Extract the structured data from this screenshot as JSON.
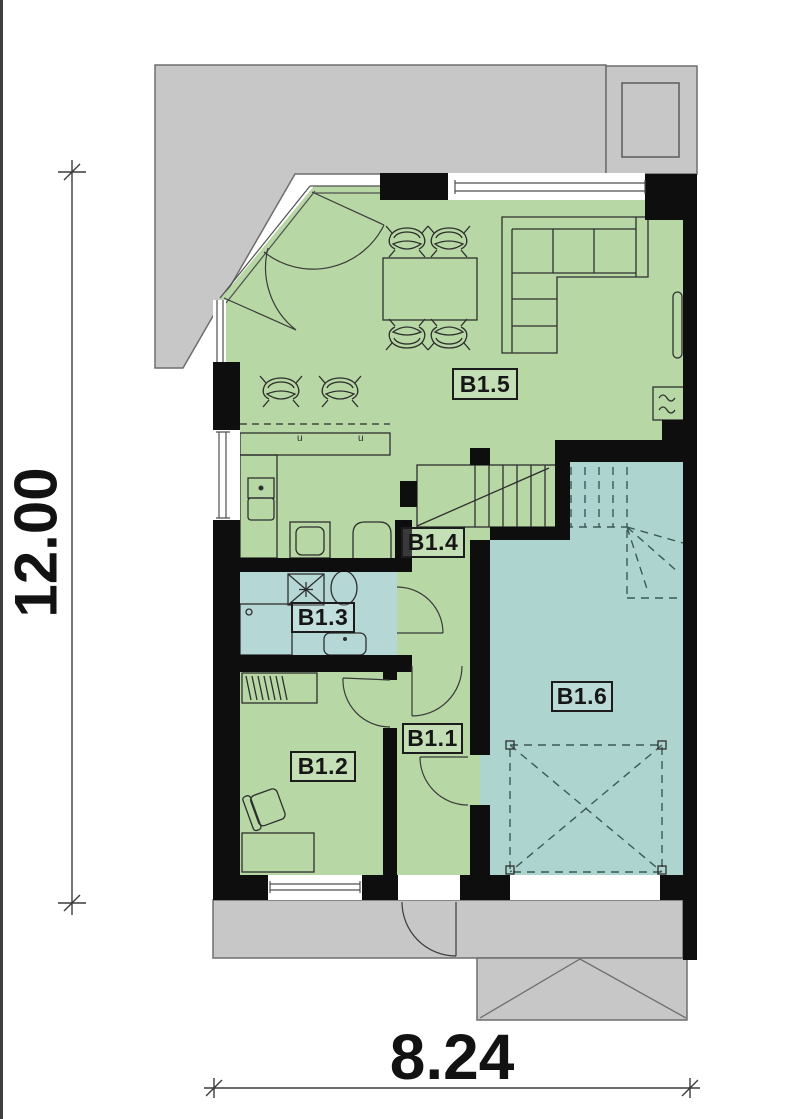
{
  "page": {
    "type": "architectural-floor-plan",
    "floor": "ground floor unit B1"
  },
  "rooms": [
    {
      "id": "b1-5",
      "label": "B1.5",
      "kind": "living-dining-kitchen",
      "color_key": "room-green"
    },
    {
      "id": "b1-4",
      "label": "B1.4",
      "kind": "hallway",
      "color_key": "room-green"
    },
    {
      "id": "b1-3",
      "label": "B1.3",
      "kind": "bathroom",
      "color_key": "room-blue"
    },
    {
      "id": "b1-2",
      "label": "B1.2",
      "kind": "room",
      "color_key": "room-green"
    },
    {
      "id": "b1-1",
      "label": "B1.1",
      "kind": "entrance-hall",
      "color_key": "room-green"
    },
    {
      "id": "b1-6",
      "label": "B1.6",
      "kind": "garage",
      "color_key": "room-blue"
    }
  ],
  "dimensions": {
    "vertical": "12.00",
    "horizontal": "8.24"
  },
  "colors": {
    "room-green": "#b7d7a5",
    "room-blue": "#aed4d0",
    "room-blue2": "#b5d8d6",
    "paving": "#c7c7c7",
    "wall": "#0e0e0e",
    "line": "#2e2e2e"
  },
  "icons": [
    "dining-table",
    "chair",
    "bar-stool",
    "corner-sofa",
    "kitchen-sink",
    "cooktop",
    "kitchen-appliance",
    "staircase",
    "washing-machine",
    "toilet",
    "shower",
    "washbasin",
    "wardrobe",
    "desk",
    "armchair",
    "radiator",
    "parking-box",
    "skylight",
    "entrance-double-door",
    "front-door",
    "window"
  ]
}
